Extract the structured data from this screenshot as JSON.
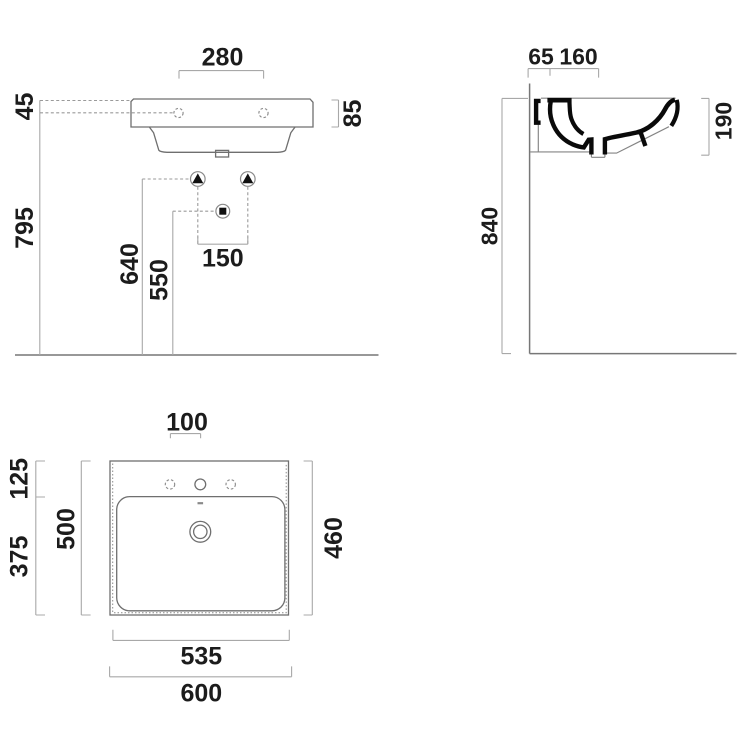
{
  "document": {
    "type": "washbasin-technical-drawing",
    "background": "#ffffff"
  },
  "colors": {
    "outline": "#6f6f6f",
    "dimension_line": "#a8a8a8",
    "dashed_line": "#9a9a9a",
    "section_fill": "#0a0a0a",
    "label_text": "#1c1c1c"
  },
  "views": {
    "front": {
      "label": "front-elevation",
      "dims": {
        "hole_spacing": "280",
        "rim_to_hole": "45",
        "rim_height": "85",
        "hole_floor_height": "795",
        "fixing_height": "640",
        "drain_height": "550",
        "fixing_spacing": "150"
      }
    },
    "side": {
      "label": "side-section",
      "dims": {
        "wall_offset": "65",
        "tap_offset": "160",
        "basin_depth": "190",
        "rim_floor_height": "840"
      }
    },
    "plan": {
      "label": "top-plan",
      "dims": {
        "tap_hole_spacing": "100",
        "rear_ledge_depth": "125",
        "bowl_zone_depth": "375",
        "overall_depth": "500",
        "inner_depth": "460",
        "base_width": "535",
        "overall_width": "600"
      }
    }
  }
}
